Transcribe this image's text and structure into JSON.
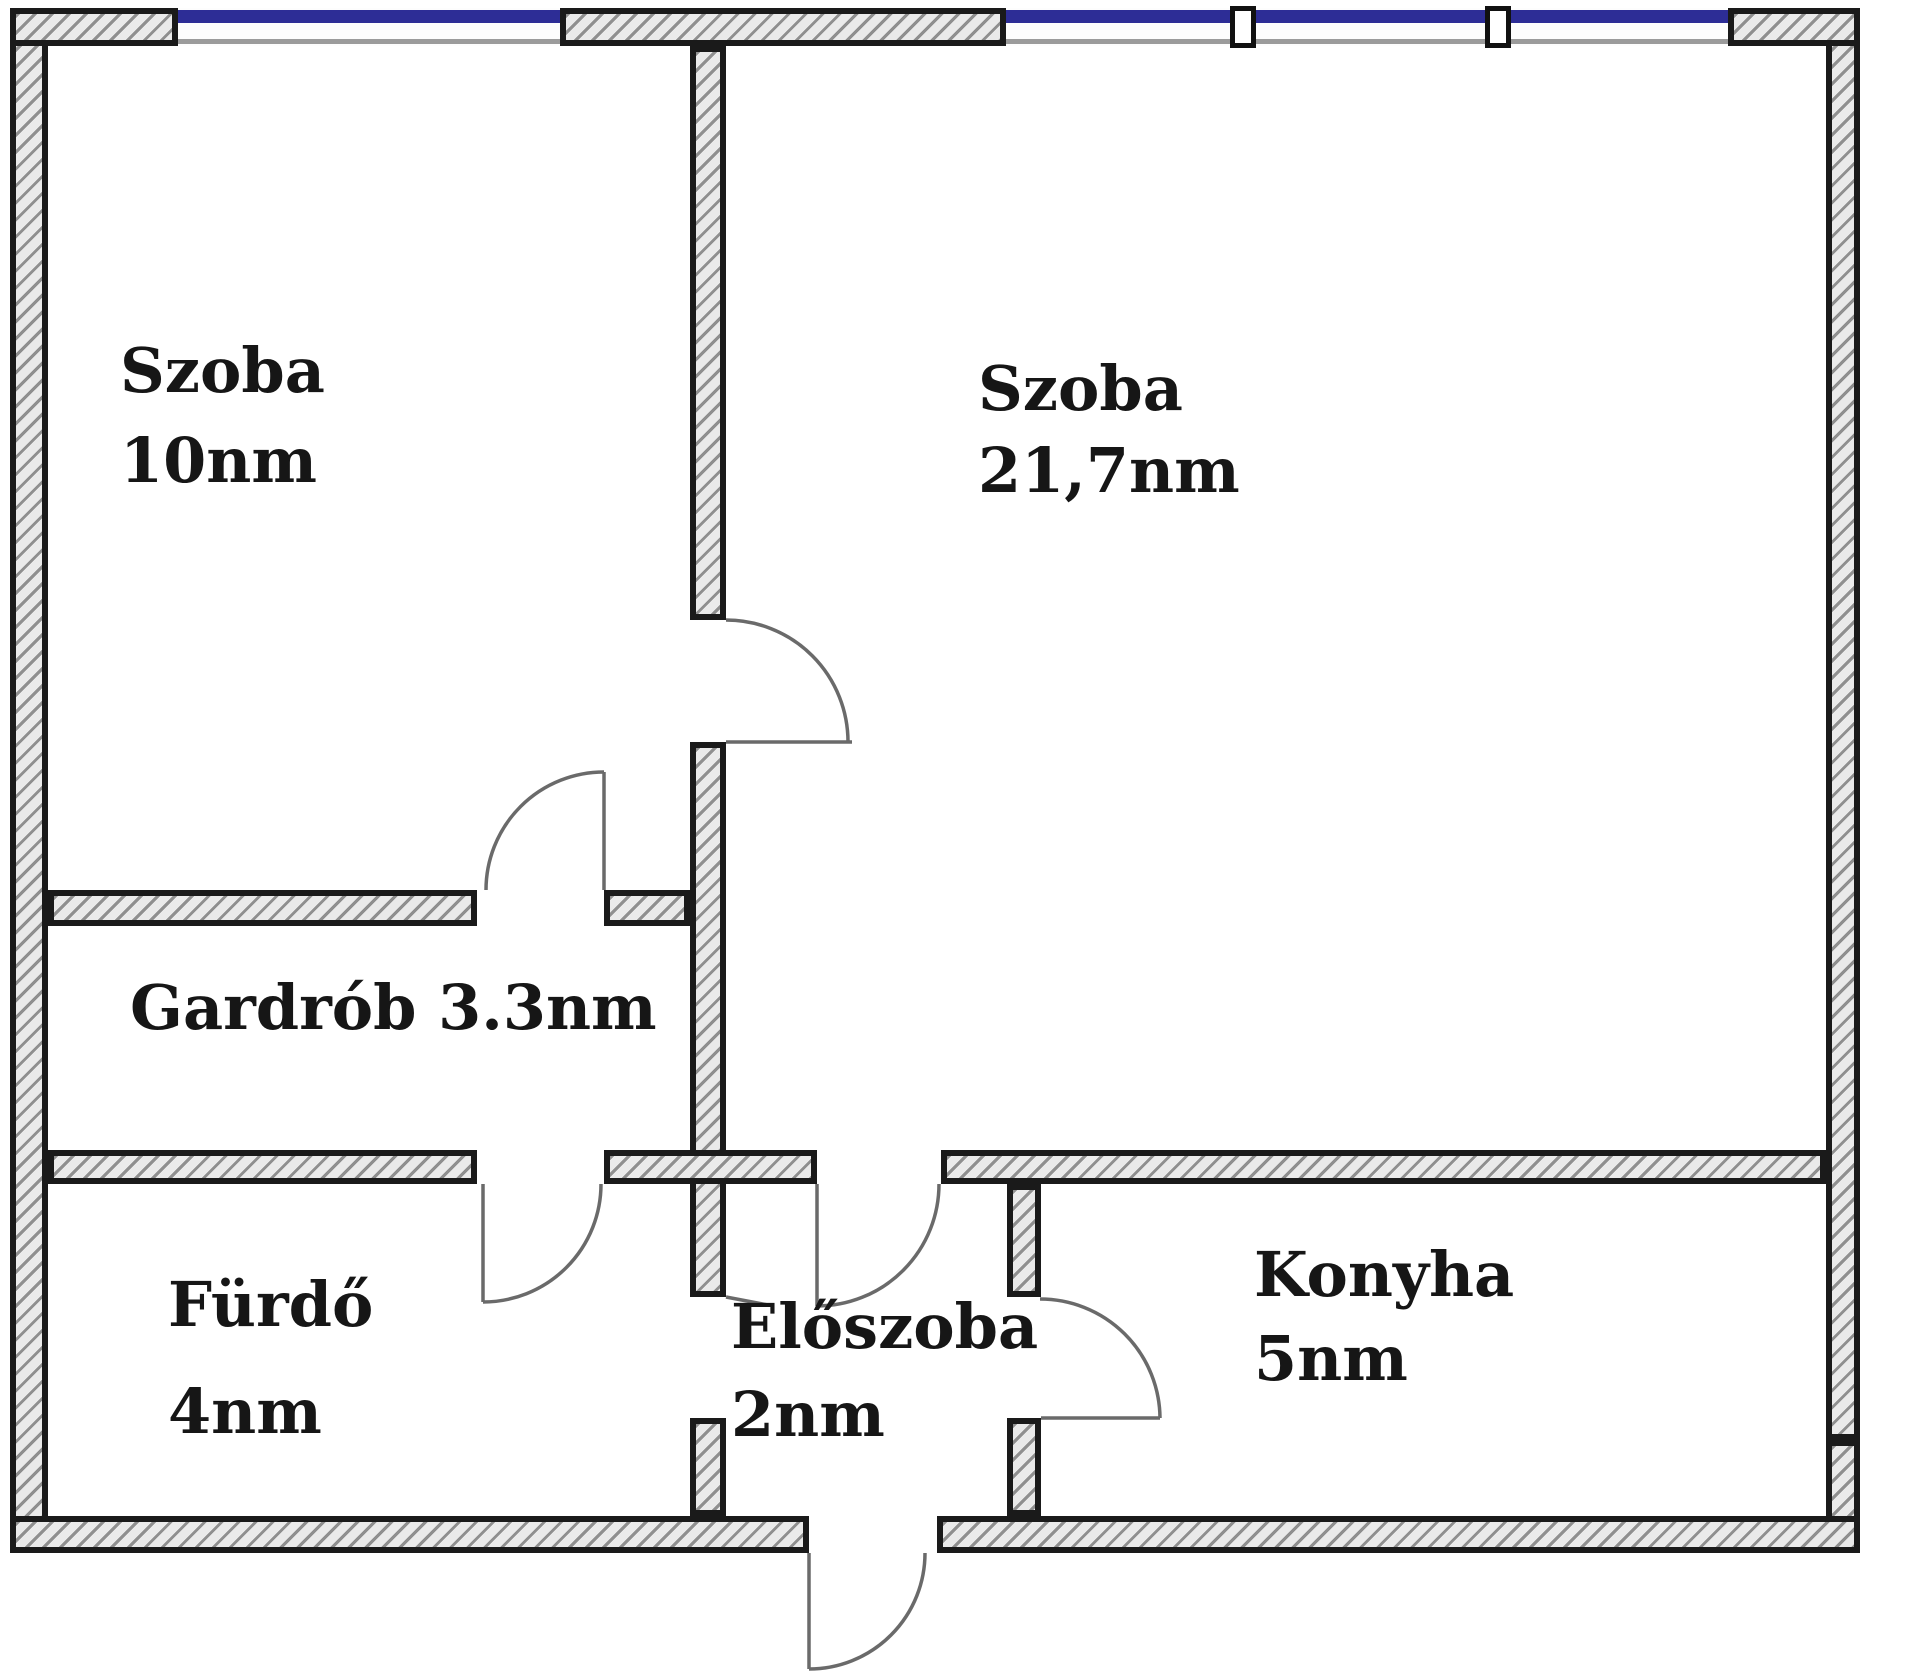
{
  "document": {
    "type": "apartment-floor-plan",
    "language": "Hungarian"
  },
  "rooms": [
    {
      "id": "szoba-10",
      "name": "Szoba",
      "area": "10nm"
    },
    {
      "id": "szoba-21",
      "name": "Szoba",
      "area": "21,7nm"
    },
    {
      "id": "gardrob",
      "name": "Gardrób",
      "area": "3.3nm"
    },
    {
      "id": "furdo",
      "name": "Fürdő",
      "area": "4nm"
    },
    {
      "id": "eloszoba",
      "name": "Előszoba",
      "area": "2nm"
    },
    {
      "id": "konyha",
      "name": "Konyha",
      "area": "5nm"
    }
  ],
  "colors": {
    "background": "#ffffff",
    "wall_edge": "#1a1a1a",
    "wall_hatch_stroke": "#8f8f8f",
    "wall_hatch_fill": "#eaeaea",
    "window_frame_blue": "#2d2d96",
    "window_inner_line": "#9b9b9b",
    "door_arc_gray": "#6a6a6a",
    "label_text": "#161616"
  }
}
